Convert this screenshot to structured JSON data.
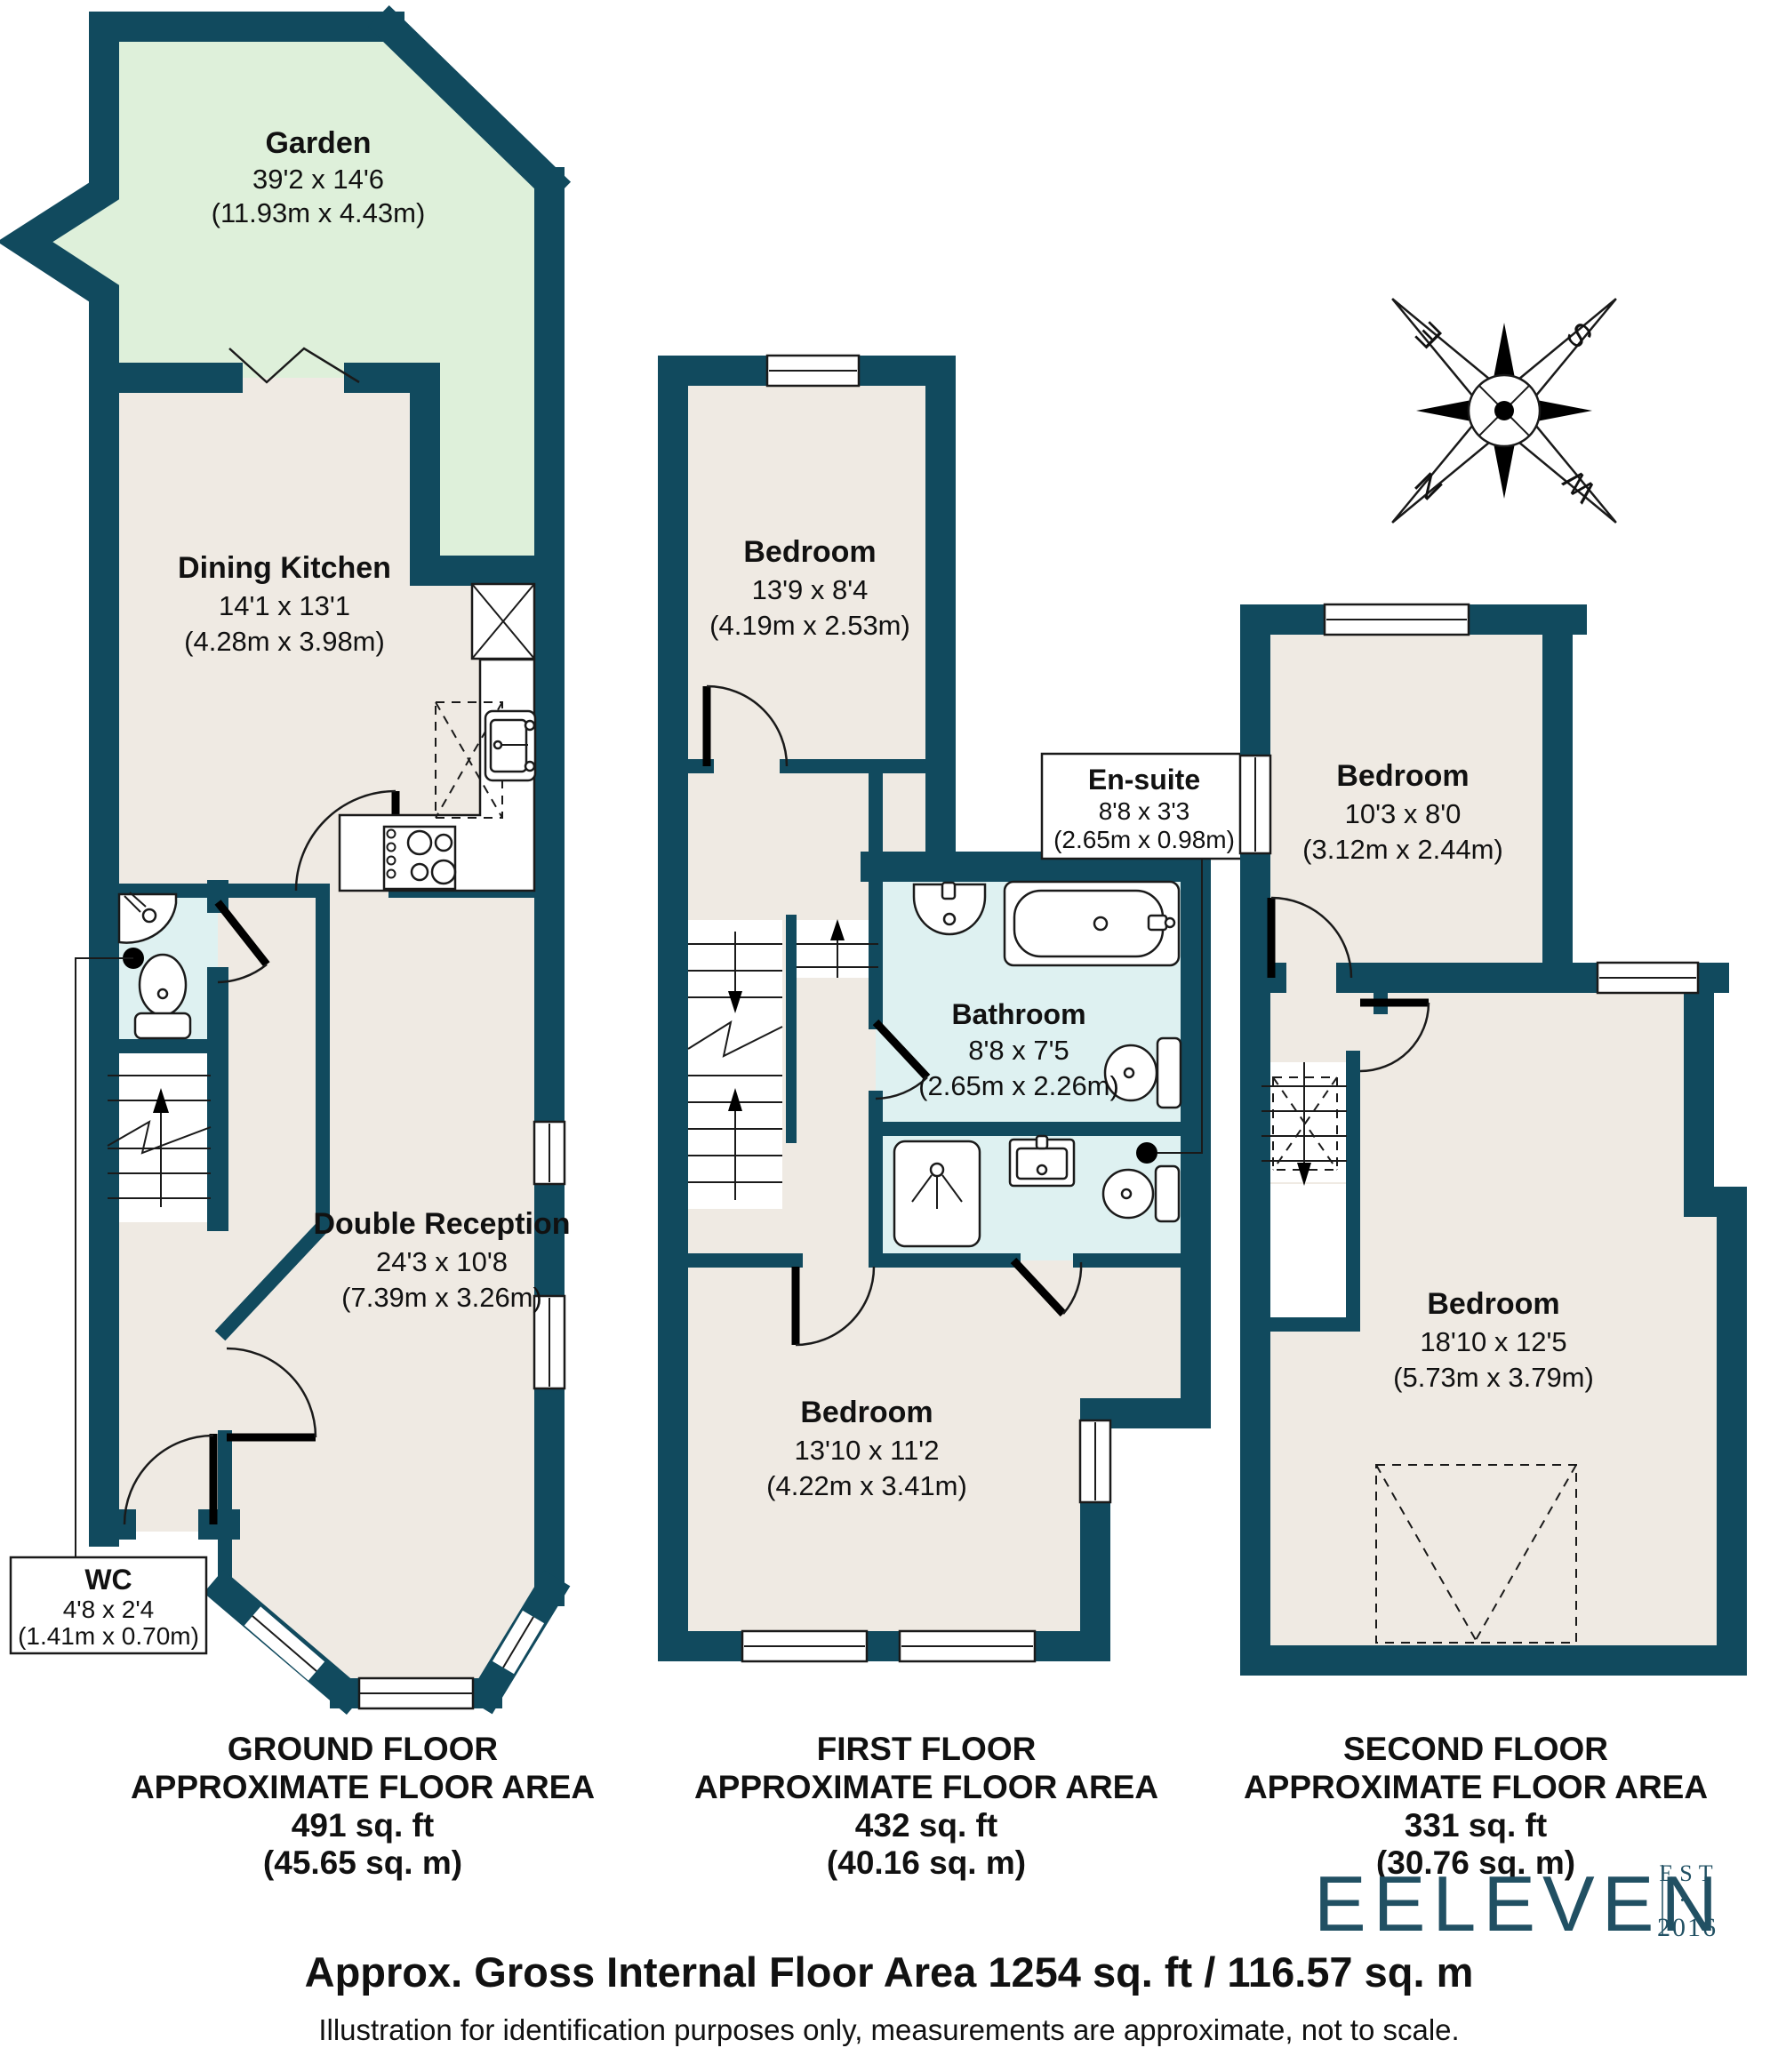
{
  "colors": {
    "wall": "#114a5e",
    "floor": "#efeae3",
    "garden": "#def0da",
    "wet_room": "#def1f1",
    "logo": "#215063"
  },
  "ground_floor": {
    "garden": {
      "name": "Garden",
      "imperial": "39'2 x 14'6",
      "metric": "(11.93m x 4.43m)"
    },
    "dining_kitchen": {
      "name": "Dining Kitchen",
      "imperial": "14'1 x 13'1",
      "metric": "(4.28m x 3.98m)"
    },
    "double_reception": {
      "name": "Double Reception",
      "imperial": "24'3 x 10'8",
      "metric": "(7.39m x 3.26m)"
    },
    "wc": {
      "name": "WC",
      "imperial": "4'8 x 2'4",
      "metric": "(1.41m x 0.70m)"
    },
    "caption": {
      "floor": "GROUND FLOOR",
      "area_label": "APPROXIMATE FLOOR AREA",
      "sqft": "491 sq. ft",
      "sqm": "(45.65 sq. m)"
    }
  },
  "first_floor": {
    "bedroom_rear": {
      "name": "Bedroom",
      "imperial": "13'9 x 8'4",
      "metric": "(4.19m x 2.53m)"
    },
    "en_suite": {
      "name": "En-suite",
      "imperial": "8'8 x 3'3",
      "metric": "(2.65m x 0.98m)"
    },
    "bathroom": {
      "name": "Bathroom",
      "imperial": "8'8 x 7'5",
      "metric": "(2.65m x 2.26m)"
    },
    "bedroom_front": {
      "name": "Bedroom",
      "imperial": "13'10 x 11'2",
      "metric": "(4.22m x 3.41m)"
    },
    "caption": {
      "floor": "FIRST FLOOR",
      "area_label": "APPROXIMATE FLOOR AREA",
      "sqft": "432 sq. ft",
      "sqm": "(40.16 sq. m)"
    }
  },
  "second_floor": {
    "bedroom_rear": {
      "name": "Bedroom",
      "imperial": "10'3 x 8'0",
      "metric": "(3.12m x 2.44m)"
    },
    "bedroom_front": {
      "name": "Bedroom",
      "imperial": "18'10 x 12'5",
      "metric": "(5.73m x 3.79m)"
    },
    "caption": {
      "floor": "SECOND FLOOR",
      "area_label": "APPROXIMATE FLOOR AREA",
      "sqft": "331 sq. ft",
      "sqm": "(30.76 sq. m)"
    }
  },
  "compass": {
    "n": "N",
    "e": "E",
    "s": "S",
    "w": "W"
  },
  "logo": {
    "name": "EELEVEN",
    "est": "EST",
    "sep": "·",
    "year": "2016"
  },
  "footer": {
    "area": "Approx. Gross Internal Floor Area 1254 sq. ft / 116.57 sq. m",
    "disclaimer": "Illustration for identification purposes only, measurements are approximate, not to scale."
  }
}
